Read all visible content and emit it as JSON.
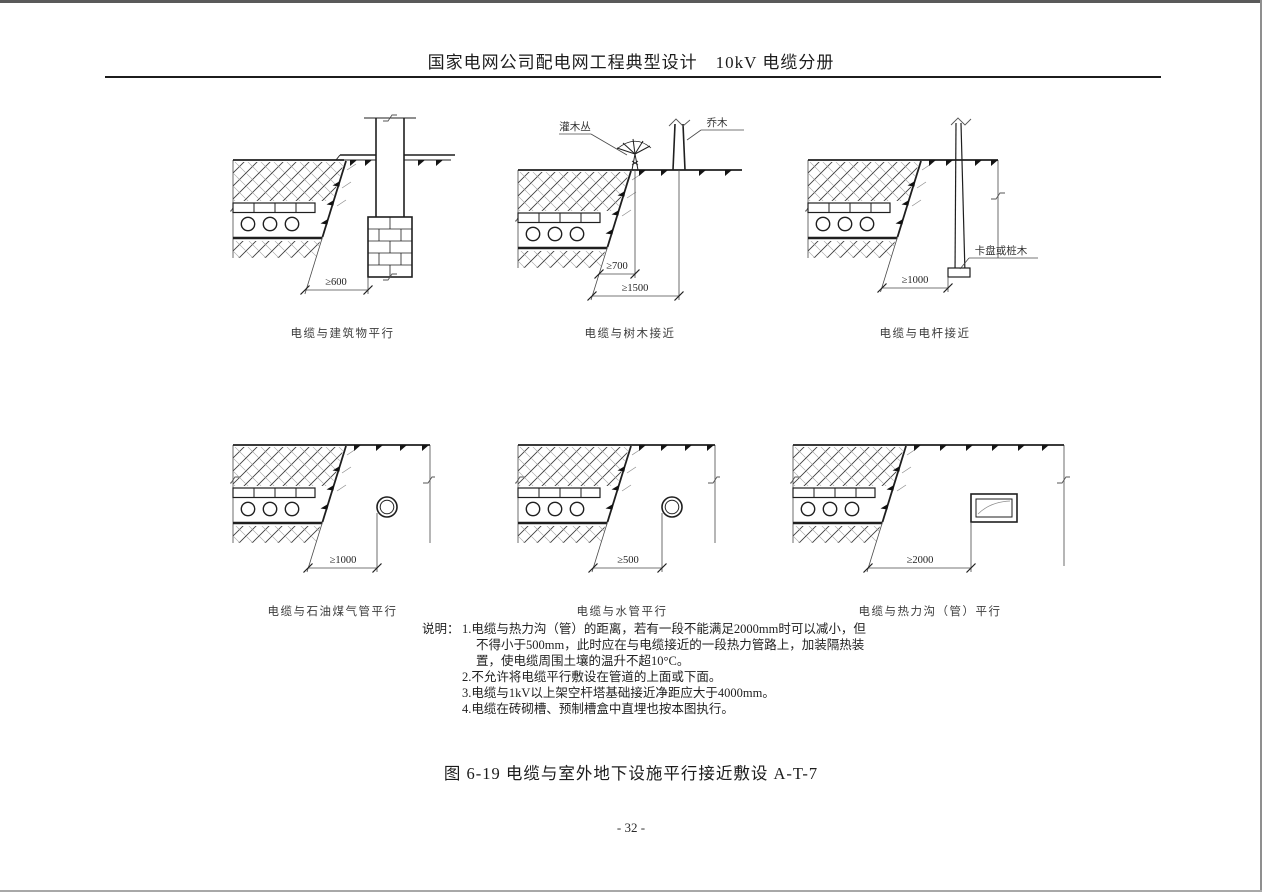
{
  "page": {
    "header_title": "国家电网公司配电网工程典型设计　10kV 电缆分册",
    "figure_caption": "图 6-19 电缆与室外地下设施平行接近敷设 A-T-7",
    "page_number": "- 32 -"
  },
  "colors": {
    "ink": "#1f1f1f",
    "paper": "#ffffff"
  },
  "diagrams": [
    {
      "caption": "电缆与建筑物平行",
      "dim1": "≥600"
    },
    {
      "caption": "电缆与树木接近",
      "dim1": "≥700",
      "dim2": "≥1500",
      "label_shrub": "灌木丛",
      "label_tree": "乔木"
    },
    {
      "caption": "电缆与电杆接近",
      "dim1": "≥1000",
      "label_pole": "卡盘或桩木"
    },
    {
      "caption": "电缆与石油煤气管平行",
      "dim1": "≥1000"
    },
    {
      "caption": "电缆与水管平行",
      "dim1": "≥500"
    },
    {
      "caption": "电缆与热力沟（管）平行",
      "dim1": "≥2000"
    }
  ],
  "notes": {
    "label": "说明：",
    "items": [
      "1.电缆与热力沟（管）的距离，若有一段不能满足2000mm时可以减小，但不得小于500mm，此时应在与电缆接近的一段热力管路上，加装隔热装置，使电缆周围土壤的温升不超10°C。",
      "2.不允许将电缆平行敷设在管道的上面或下面。",
      "3.电缆与1kV以上架空杆塔基础接近净距应大于4000mm。",
      "4.电缆在砖砌槽、预制槽盒中直埋也按本图执行。"
    ]
  }
}
